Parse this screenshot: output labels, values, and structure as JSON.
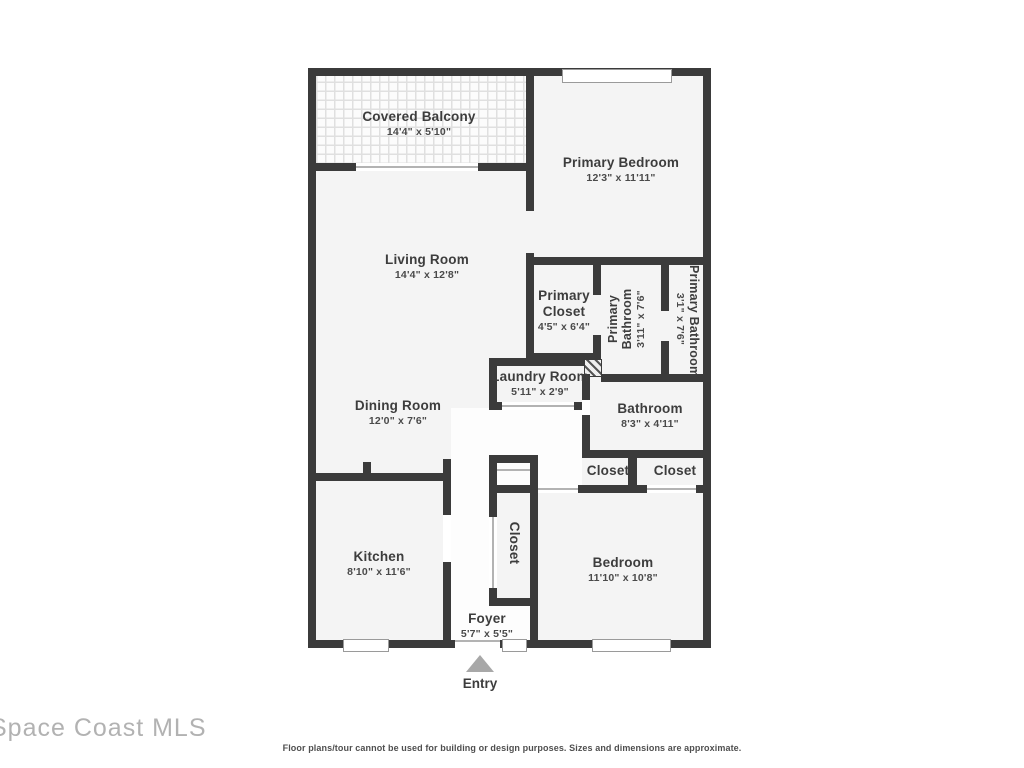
{
  "plan": {
    "rooms": {
      "covered_balcony": {
        "name": "Covered Balcony",
        "dims": "14'4\" x 5'10\""
      },
      "primary_bedroom": {
        "name": "Primary Bedroom",
        "dims": "12'3\" x 11'11\""
      },
      "living_room": {
        "name": "Living Room",
        "dims": "14'4\" x 12'8\""
      },
      "primary_closet": {
        "name": "Primary Closet",
        "dims": "4'5\" x 6'4\""
      },
      "primary_bathroom_inner": {
        "name": "Primary Bathroom",
        "dims": "3'11\" x 7'6\""
      },
      "primary_bathroom_outer": {
        "name": "Primary Bathroom",
        "dims": "3'1\" x 7'6\""
      },
      "laundry_room": {
        "name": "Laundry Room",
        "dims": "5'11\" x 2'9\""
      },
      "dining_room": {
        "name": "Dining Room",
        "dims": "12'0\" x 7'6\""
      },
      "bathroom": {
        "name": "Bathroom",
        "dims": "8'3\" x 4'11\""
      },
      "closet_hall_small": {
        "name": "Closet"
      },
      "closet_hall_right": {
        "name": "Closet"
      },
      "kitchen": {
        "name": "Kitchen",
        "dims": "8'10\" x 11'6\""
      },
      "closet_foyer": {
        "name": "Closet"
      },
      "bedroom": {
        "name": "Bedroom",
        "dims": "11'10\" x 10'8\""
      },
      "foyer": {
        "name": "Foyer",
        "dims": "5'7\" x 5'5\""
      }
    },
    "entry_label": "Entry"
  },
  "watermark": "Space Coast MLS",
  "disclaimer": "Floor plans/tour cannot be used for building or design purposes. Sizes and dimensions are approximate.",
  "colors": {
    "wall": "#3b3b3b",
    "floor": "#f4f4f4",
    "label": "#3d3d3d",
    "watermark": "#b2b2b2",
    "entry_arrow": "#a8a8a8"
  }
}
